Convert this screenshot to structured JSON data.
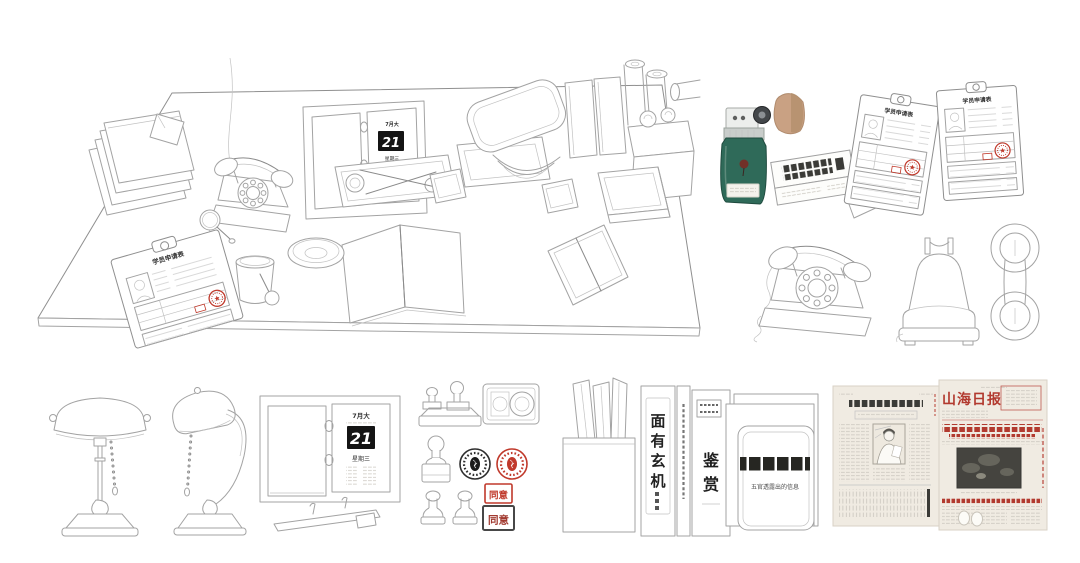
{
  "colors": {
    "line": "#a3a3a3",
    "line_dark": "#8a8a8a",
    "seal_red": "#c0392b",
    "calendar_black": "#141414",
    "bottle_green": "#2f6a59",
    "cork_tan": "#c9a183",
    "newsprint": "#f0ebe2",
    "news_red": "#b23a2f",
    "photo_dark": "#45443f"
  },
  "calendar": {
    "month_header": "7月大",
    "date": "21",
    "weekday": "星期三"
  },
  "clipboard_form": {
    "title": "学员申请表"
  },
  "books": {
    "spine_chars": [
      "面",
      "有",
      "玄",
      "机"
    ],
    "cover_chars": [
      "鉴",
      "赏"
    ]
  },
  "folders": {
    "subtitle": "五官透露出的信息"
  },
  "seals": {
    "square_red": "同意",
    "square_dark": "同意"
  },
  "newspaper": {
    "masthead": "山海日报"
  }
}
